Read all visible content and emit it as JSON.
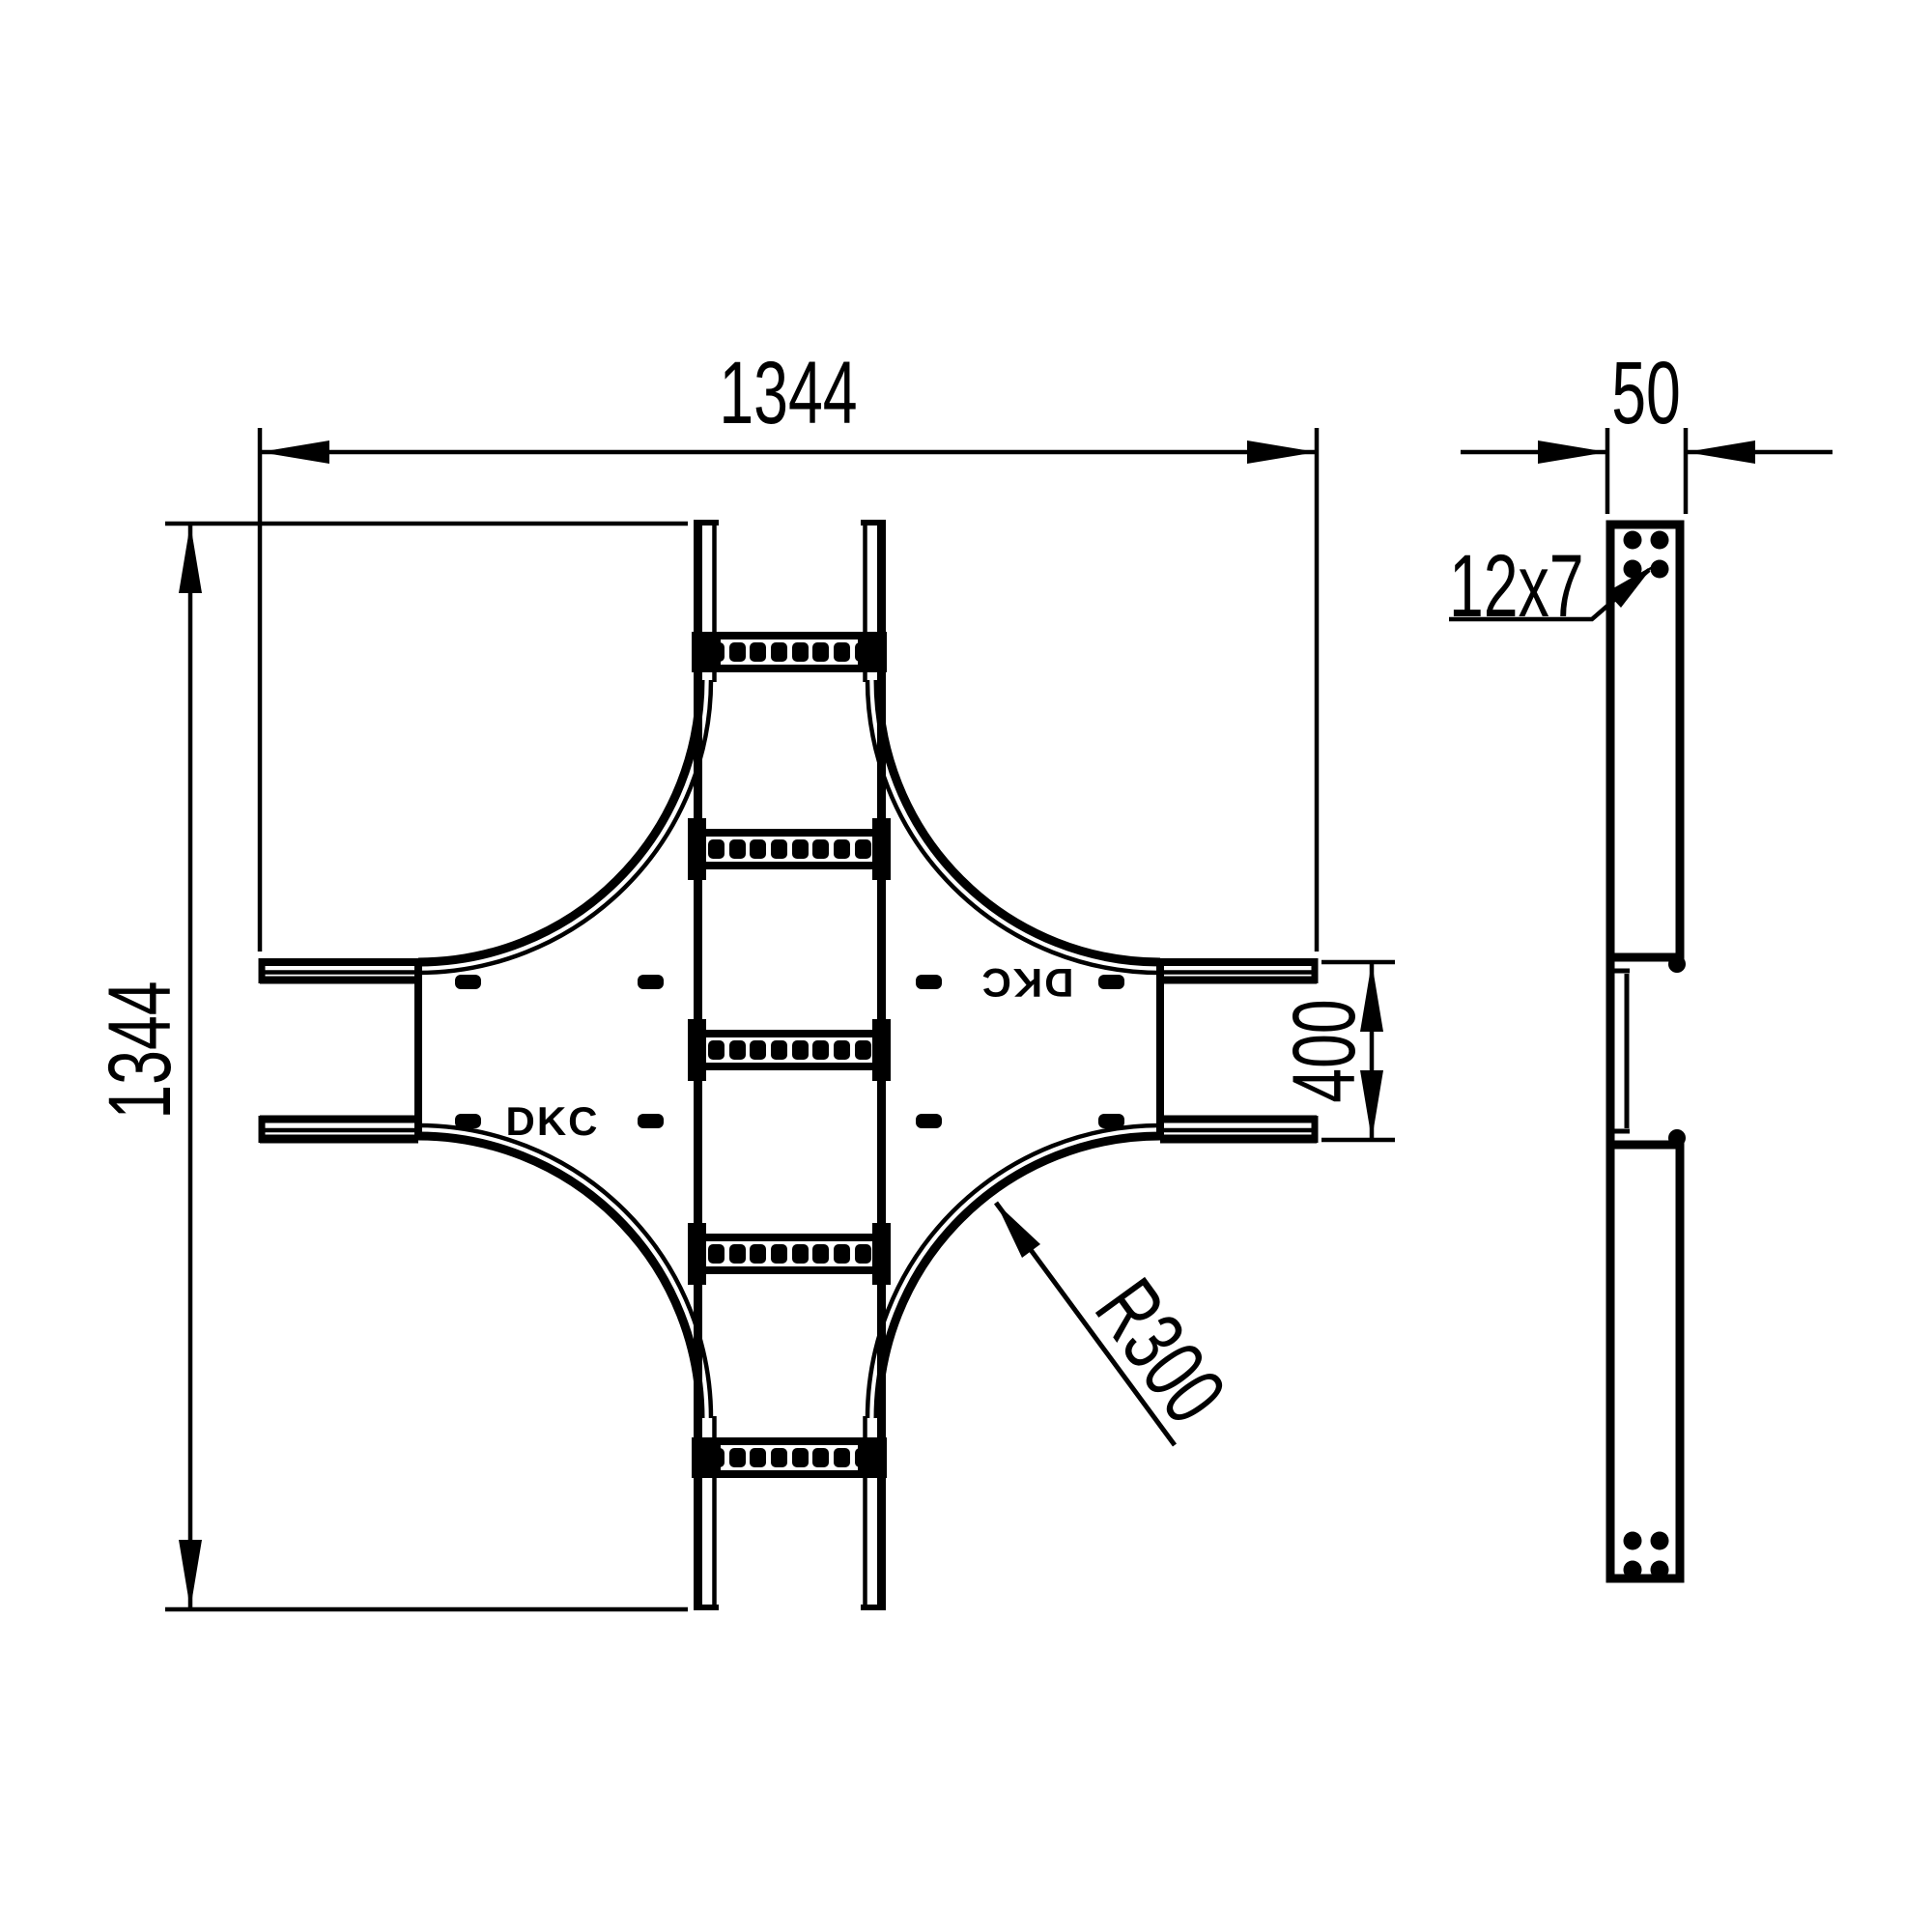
{
  "plan_view": {
    "dim_overall_width": "1344",
    "dim_overall_height": "1344",
    "dim_branch_width": "400",
    "dim_corner_radius": "R300",
    "logo": "DKC",
    "logo_mirrored": "DKC"
  },
  "side_view": {
    "dim_profile_height": "50",
    "dim_slot_size": "12x7"
  },
  "colors": {
    "line": "#000000",
    "background": "#ffffff"
  }
}
